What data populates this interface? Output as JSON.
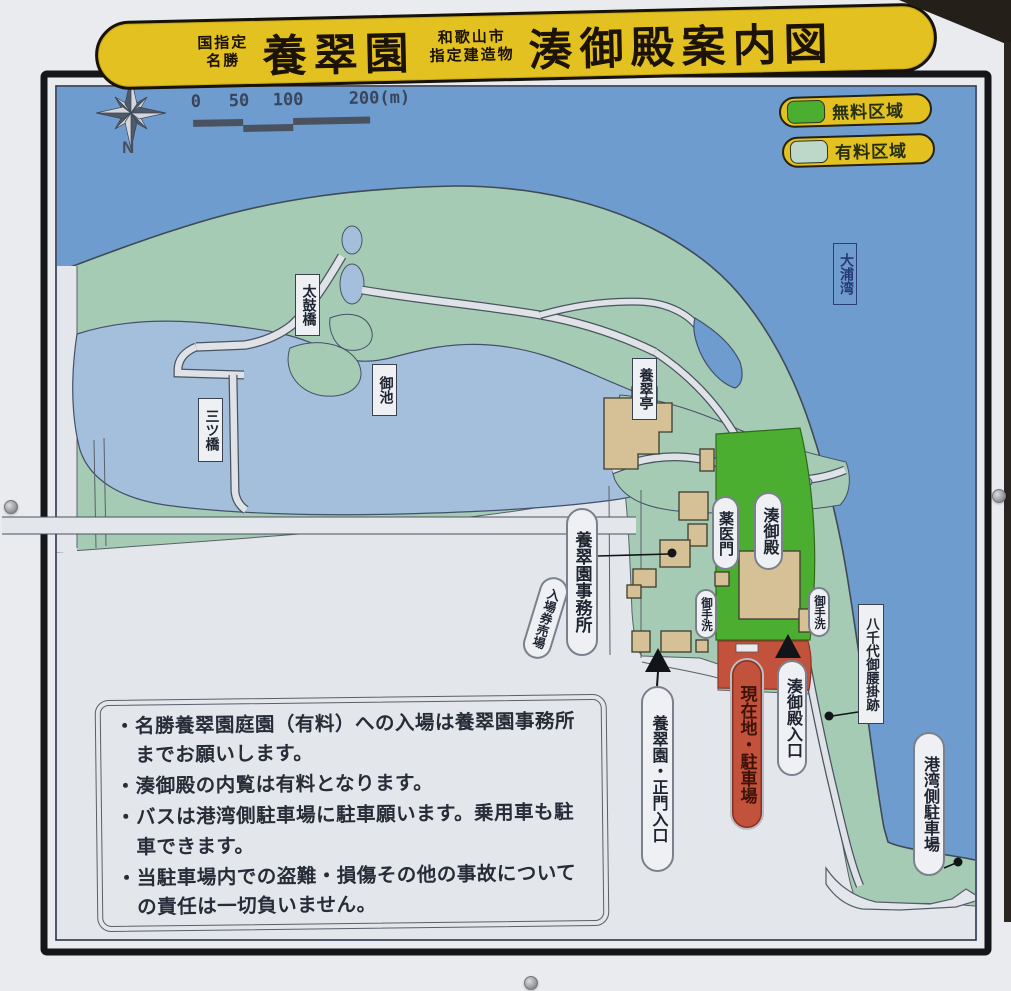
{
  "sign": {
    "banner": {
      "designation_left_line1": "国指定",
      "designation_left_line2": "名勝",
      "site_name": "養翠園",
      "designation_right_line1": "和歌山市",
      "designation_right_line2": "指定建造物",
      "map_title": "湊御殿案内図"
    },
    "compass": {
      "north_label": "N"
    },
    "scale_bar": {
      "ticks": [
        "0",
        "50",
        "100",
        "200(m)"
      ]
    },
    "legend": {
      "items": [
        {
          "label": "無料区域",
          "color": "#4bae31"
        },
        {
          "label": "有料区域",
          "color": "#bdd8c9"
        }
      ]
    },
    "map": {
      "colors": {
        "sea": "#6f9cce",
        "pond": "#a4bfdc",
        "garden_land": "#a6cbb4",
        "free_area": "#4bae31",
        "parking": "#c3523c",
        "building": "#d6c096"
      },
      "labels": {
        "taikobashi": "太鼓橋",
        "oike": "御池",
        "mitsubashi": "三ツ橋",
        "yosuitei": "養翠亭",
        "ourawan": "大浦湾",
        "yakuimon": "薬医門",
        "minatogoten": "湊御殿",
        "jimusho": "養翠園事務所",
        "nyujoken": "入場券売場",
        "otearai_left": "御手洗",
        "otearai_right": "御手洗",
        "yachiyo": "八千代御腰掛跡",
        "seimon": "養翠園・正門入口",
        "genzaichi": "現在地・駐車場",
        "minato_iriguchi": "湊御殿入口",
        "kowan": "港湾側駐車場"
      }
    },
    "notice": {
      "bullet": "・",
      "items": [
        "名勝養翠園庭園（有料）への入場は養翠園事務所までお願いします。",
        "湊御殿の内覧は有料となります。",
        "バスは港湾側駐車場に駐車願います。乗用車も駐車できます。",
        "当駐車場内での盗難・損傷その他の事故についての責任は一切負いません。"
      ]
    }
  }
}
